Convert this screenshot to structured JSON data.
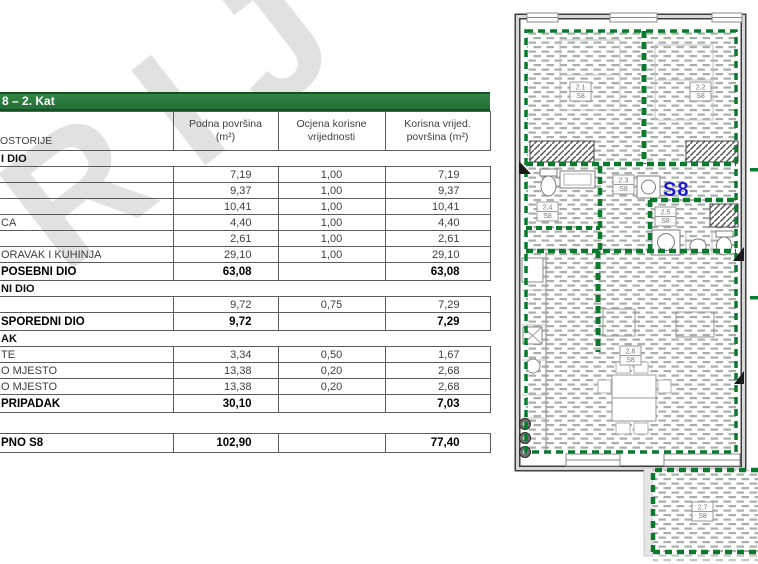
{
  "watermark": {
    "text": "RIJ"
  },
  "table": {
    "title": "8 – 2. Kat",
    "header": {
      "rooms": "OSTORIJE",
      "col1_line1": "Podna površina",
      "col1_line2": "(m²)",
      "col2_line1": "Ocjena korisne",
      "col2_line2": "vrijednosti",
      "col3_line1": "Korisna vrijed.",
      "col3_line2": "površina (m²)"
    },
    "rows": [
      {
        "type": "section",
        "label": "I DIO",
        "podna": "",
        "ocjena": "",
        "korisna": ""
      },
      {
        "type": "data",
        "label": "",
        "podna": "7,19",
        "ocjena": "1,00",
        "korisna": "7,19"
      },
      {
        "type": "data",
        "label": "",
        "podna": "9,37",
        "ocjena": "1,00",
        "korisna": "9,37"
      },
      {
        "type": "data",
        "label": "",
        "podna": "10,41",
        "ocjena": "1,00",
        "korisna": "10,41"
      },
      {
        "type": "data",
        "label": "CA",
        "podna": "4,40",
        "ocjena": "1,00",
        "korisna": "4,40"
      },
      {
        "type": "data",
        "label": "",
        "podna": "2,61",
        "ocjena": "1,00",
        "korisna": "2,61"
      },
      {
        "type": "data",
        "label": "ORAVAK I KUHINJA",
        "podna": "29,10",
        "ocjena": "1,00",
        "korisna": "29,10"
      },
      {
        "type": "total",
        "label": "POSEBNI DIO",
        "podna": "63,08",
        "ocjena": "",
        "korisna": "63,08"
      },
      {
        "type": "section",
        "label": "NI DIO",
        "podna": "",
        "ocjena": "",
        "korisna": ""
      },
      {
        "type": "data",
        "label": "",
        "podna": "9,72",
        "ocjena": "0,75",
        "korisna": "7,29"
      },
      {
        "type": "total",
        "label": "SPOREDNI DIO",
        "podna": "9,72",
        "ocjena": "",
        "korisna": "7,29"
      },
      {
        "type": "section",
        "label": "AK",
        "podna": "",
        "ocjena": "",
        "korisna": ""
      },
      {
        "type": "data",
        "label": "TE",
        "podna": "3,34",
        "ocjena": "0,50",
        "korisna": "1,67"
      },
      {
        "type": "data",
        "label": "O MJESTO",
        "podna": "13,38",
        "ocjena": "0,20",
        "korisna": "2,68"
      },
      {
        "type": "data",
        "label": "O MJESTO",
        "podna": "13,38",
        "ocjena": "0,20",
        "korisna": "2,68"
      },
      {
        "type": "total",
        "label": "PRIPADAK",
        "podna": "30,10",
        "ocjena": "",
        "korisna": "7,03"
      },
      {
        "type": "spacer",
        "label": "",
        "podna": "",
        "ocjena": "",
        "korisna": ""
      },
      {
        "type": "grand",
        "label": "PNO S8",
        "podna": "102,90",
        "ocjena": "",
        "korisna": "77,40"
      }
    ]
  },
  "plan": {
    "unit_label": "S8",
    "rooms": [
      {
        "id": "2.1",
        "unit": "S8"
      },
      {
        "id": "2.2",
        "unit": "S8"
      },
      {
        "id": "2.3",
        "unit": "S8"
      },
      {
        "id": "2.4",
        "unit": "S8"
      },
      {
        "id": "2.5",
        "unit": "S8"
      },
      {
        "id": "2.6",
        "unit": "S8"
      },
      {
        "id": "2.7",
        "unit": "S8"
      }
    ],
    "colors": {
      "boundary_green": "#0c7a2e",
      "title_bar_green": "#2a7a3a",
      "unit_blue": "#1d1dce"
    }
  }
}
